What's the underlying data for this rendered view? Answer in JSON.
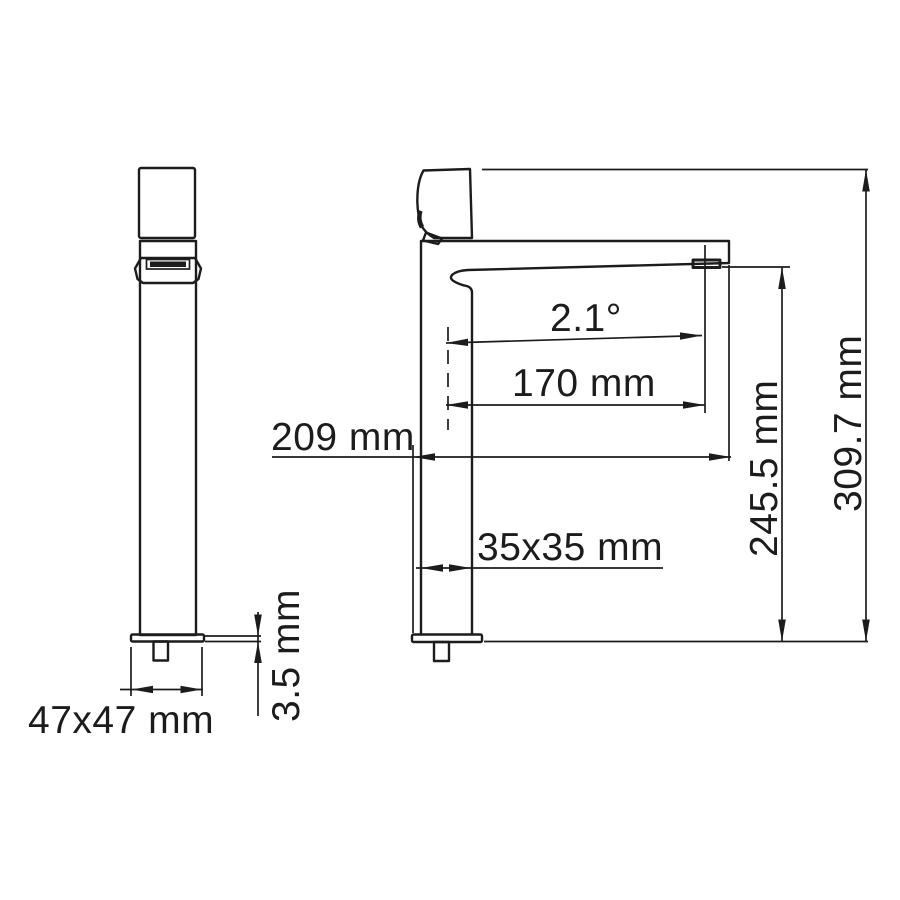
{
  "drawing": {
    "background_color": "#ffffff",
    "line_color": "#1c1c1c",
    "views": {
      "front": {
        "name": "front view"
      },
      "side": {
        "name": "side view"
      }
    },
    "dimensions": {
      "base_footprint": {
        "label": "47x47 mm",
        "value": "47x47",
        "unit": "mm"
      },
      "plate_thickness": {
        "label": "3.5 mm",
        "value": 3.5,
        "unit": "mm"
      },
      "spout_angle": {
        "label": "2.1°",
        "value": 2.1,
        "unit": "deg"
      },
      "spout_reach": {
        "label": "170 mm",
        "value": 170,
        "unit": "mm"
      },
      "overall_reach": {
        "label": "209 mm",
        "value": 209,
        "unit": "mm"
      },
      "body_cross_section": {
        "label": "35x35 mm",
        "value": "35x35",
        "unit": "mm"
      },
      "outlet_height": {
        "label": "245.5 mm",
        "value": 245.5,
        "unit": "mm"
      },
      "overall_height": {
        "label": "309.7 mm",
        "value": 309.7,
        "unit": "mm"
      }
    }
  }
}
